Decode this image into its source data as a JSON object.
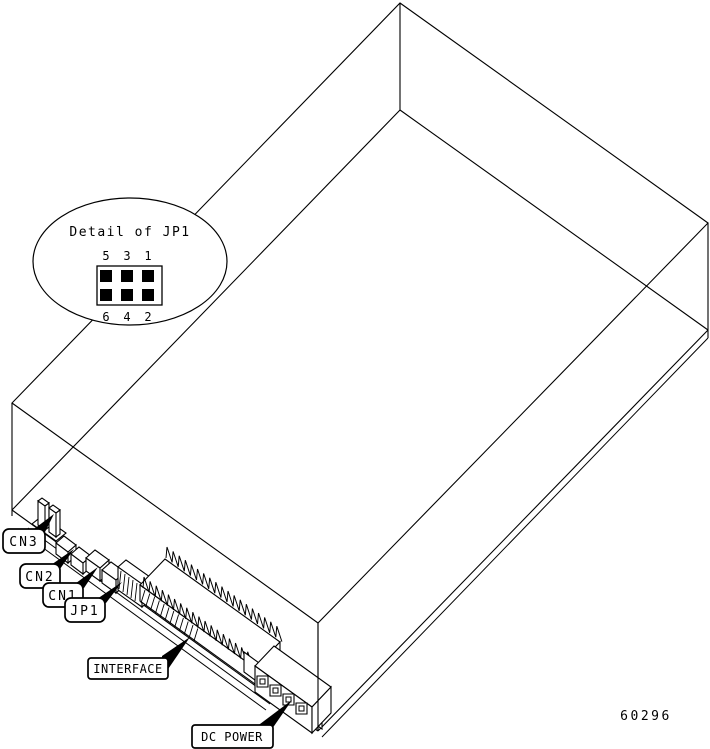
{
  "diagram": {
    "detail_callout": {
      "title": "Detail of JP1",
      "pins_top": [
        "5",
        "3",
        "1"
      ],
      "pins_bottom": [
        "6",
        "4",
        "2"
      ]
    },
    "labels": {
      "cn3": "CN3",
      "cn2": "CN2",
      "cn1": "CN1",
      "jp1": "JP1",
      "interface": "INTERFACE",
      "dc_power": "DC POWER"
    },
    "figure_number": "60296",
    "colors": {
      "line": "#000000",
      "background": "#ffffff",
      "pin_fill": "#000000"
    }
  }
}
